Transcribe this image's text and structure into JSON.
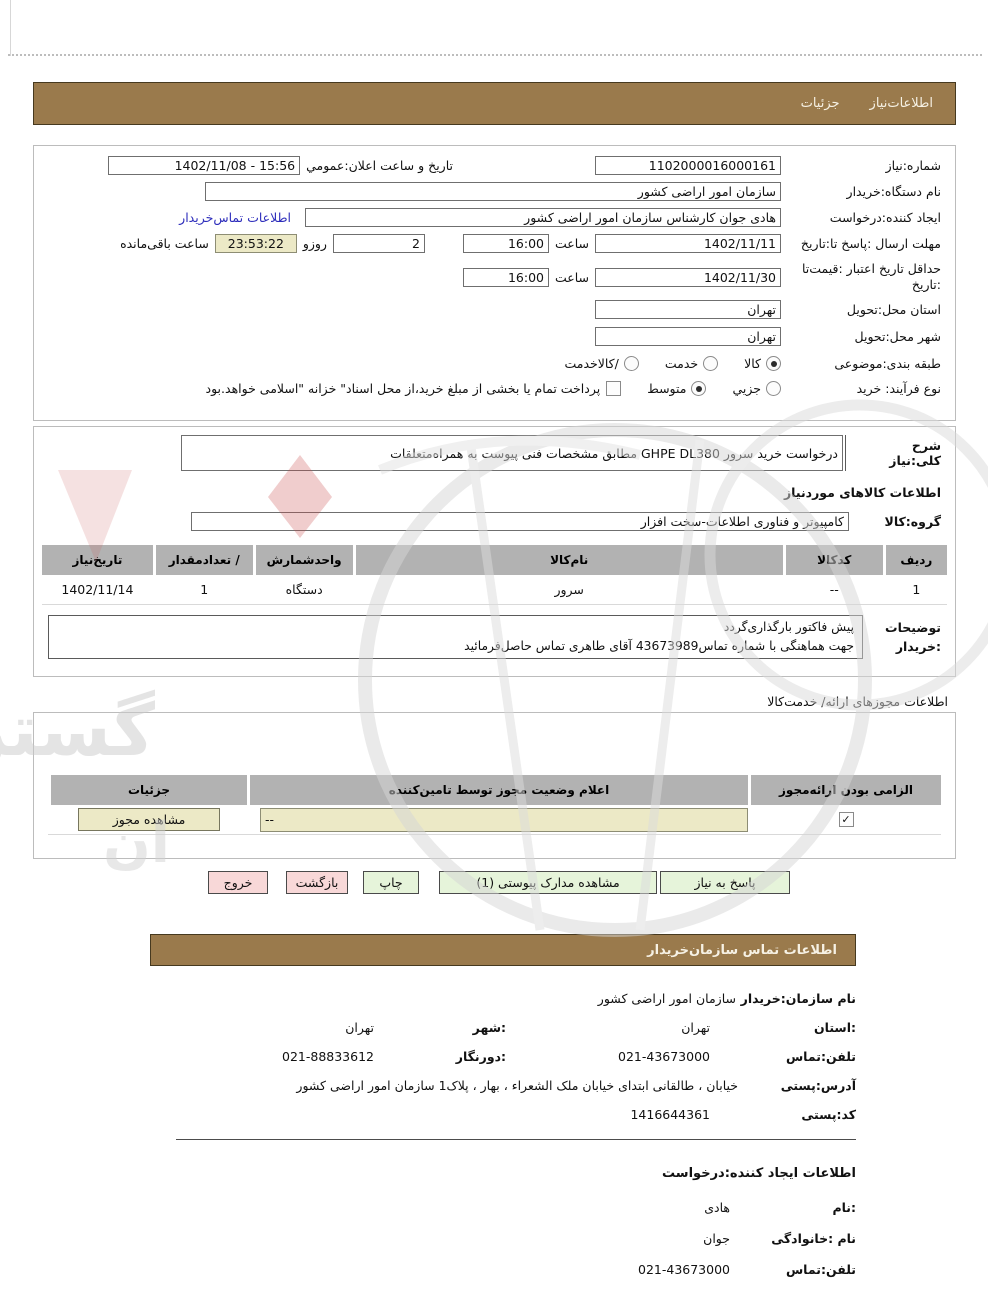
{
  "colors": {
    "brown_bar": "#9a7a4c",
    "beige_field": "#ece9c6",
    "green_button": "#e6f4da",
    "pink_button": "#f8d8d8",
    "table_header_gray": "#b2b2b2",
    "link_blue": "#2d2dbb"
  },
  "tabs": {
    "details": "جزئیات",
    "need_info": "اطلاعات‌نیاز"
  },
  "form": {
    "need_number": {
      "label": "شماره:نیاز",
      "value": "1102000016000161"
    },
    "announce": {
      "label": "تاریخ و ساعت اعلان:عمومي",
      "value": "1402/11/08 - 15:56"
    },
    "buyer_org": {
      "label": "نام دستگاه:خریدار",
      "value": "سازمان امور اراضی کشور"
    },
    "creator": {
      "label": "ایجاد کننده:درخواست",
      "value": "هادی جوان کارشناس سازمان امور اراضی کشور",
      "link": "اطلاعات تماس‌خریدار"
    },
    "deadline": {
      "label": "مهلت ارسال :پاسخ تا:تاریخ",
      "date": "1402/11/11",
      "time_label": "ساعت",
      "time": "16:00",
      "days": "2",
      "days_label": "روزو",
      "countdown": "23:53:22",
      "countdown_label": "ساعت باقی‌مانده"
    },
    "validity": {
      "label_line1": "حداقل تاریخ اعتبار :قیمت‌تا",
      "label_line2": ":تاریخ",
      "date": "1402/11/30",
      "time_label": "ساعت",
      "time": "16:00"
    },
    "province": {
      "label": "استان محل:تحویل",
      "value": "تهران"
    },
    "city": {
      "label": "شهر محل:تحویل",
      "value": "تهران"
    },
    "classification": {
      "label": "طبقه بندی:موضوعی",
      "options": [
        {
          "label": "کالا",
          "selected": true
        },
        {
          "label": "خدمت",
          "selected": false
        },
        {
          "label": "/کالاخدمت",
          "selected": false
        }
      ]
    },
    "process": {
      "label": "نوع فرآیند: خرید",
      "options": [
        {
          "label": "جزیي",
          "selected": false
        },
        {
          "label": "متوسط",
          "selected": true
        }
      ],
      "checkbox_label": "پرداخت تمام یا بخشی از مبلغ خرید،از محل اسناد\" خزانه \"اسلامی خواهد.بود",
      "checkbox_checked": false
    }
  },
  "need_desc": {
    "label": "شرح کلی:نیاز",
    "value": "درخواست خرید سرور GHPE DL380 مطابق مشخصات فنی پیوست به همراه‌متعلقات"
  },
  "goods": {
    "title": "اطلاعات کالاهای موردنیاز",
    "group_label": "گروه:کالا",
    "group_value": "کامپیوتر و فناوری اطلاعات-سخت افزار",
    "table": {
      "headers": [
        "ردیف",
        "کدکالا",
        "نام‌کالا",
        "واحدشمارش",
        "/ تعدادمقدار",
        "تاریخ‌نیاز"
      ],
      "rows": [
        [
          "1",
          "--",
          "سرور",
          "دستگاه",
          "1",
          "1402/11/14"
        ]
      ]
    },
    "notes": {
      "label_line1": "توضیحات",
      "label_line2": ":خریدار",
      "lines": [
        "پیش فاکتور بارگذاری‌گردد",
        "جهت هماهنگی با شماره تماس43673989 آقای طاهری تماس حاصل‌فرمائید"
      ]
    }
  },
  "license": {
    "title": "اطلاعات مجوزهای ارائه/ خدمت‌کالا",
    "headers": [
      "الزامی بودن ارائه‌مجوز",
      "اعلام وضعیت مجوز توسط تامین‌کننده",
      "جزئیات"
    ],
    "row": {
      "required_checked": true,
      "status_value": "--",
      "details_button": "مشاهده مجوز"
    }
  },
  "actions": {
    "respond": "پاسخ به نیاز",
    "view_docs": "مشاهده مدارک پیوستی (1)",
    "print": "چاپ",
    "back": "بازگشت",
    "exit": "خروج"
  },
  "contact": {
    "title": "اطلاعات  تماس سازمان‌خریدار",
    "org_label": "نام سازمان:خریدار",
    "org_value": "سازمان امور اراضی کشور",
    "province_label": ":استان",
    "province_value": "تهران",
    "city_label": ":شهر",
    "city_value": "تهران",
    "phone_label": "تلفن:تماس",
    "phone_value": "021-43673000",
    "fax_label": ":دورنگار",
    "fax_value": "021-88833612",
    "address_label": "آدرس:پستی",
    "address_value": "خیابان ، طالقانی ابتدای خیابان ملک الشعراء ، بهار ، پلاک1 سازمان امور اراضی کشور",
    "postal_label": "کد:پستی",
    "postal_value": "1416644361"
  },
  "creator_info": {
    "title": "اطلاعات ایجاد کننده:درخواست",
    "name_label": ":نام",
    "name_value": "هادی",
    "family_label": "نام :خانوادگی",
    "family_value": "جوان",
    "phone_label": "تلفن:تماس",
    "phone_value": "021-43673000"
  },
  "watermark": {
    "text_main": "گستران",
    "text_small": "ان"
  }
}
